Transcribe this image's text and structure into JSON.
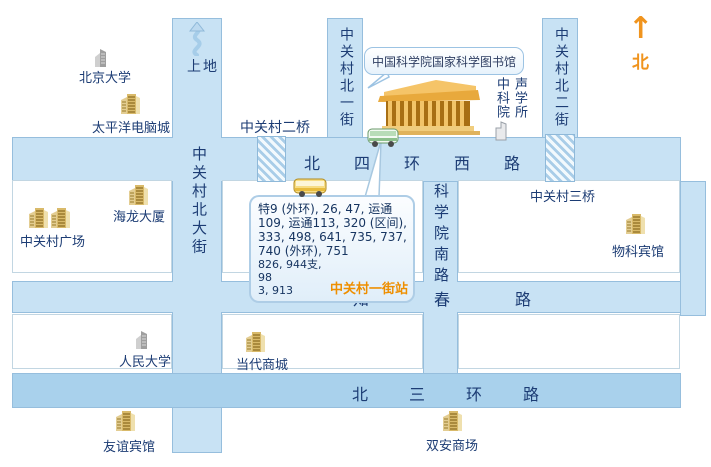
{
  "map": {
    "callout_library": "中国科学院国家科学图书馆",
    "north_indicator": {
      "arrow": "↑",
      "label": "北"
    },
    "roads": {
      "beisihuan_xilu": "北四环西路",
      "zhichun_lu": "知春路",
      "beisanhuan_lu": "北三环路",
      "zhongguancun_bei_dajie": "中关村北大街",
      "zhongguancun_beiyi_jie": "中关村北一街",
      "zhongguancun_beier_jie": "中关村北二街",
      "kexueyuan_nanlu": "科学院南路",
      "shangdi": "上地"
    },
    "bridges": {
      "erqiao": "中关村二桥",
      "sanqiao": "中关村三桥"
    },
    "bus_callout": {
      "routes_main": "特9 (外环), 26, 47, 运通109, 运通113, 320 (区间), 333, 498, 641, 735, 737, 740 (外环), 751",
      "routes_extra_line1": "826, 944支, 98",
      "routes_extra_line2": "3, 913",
      "station": "中关村一街站"
    },
    "places": {
      "beijing_university": "北京大学",
      "pacific_computer_city": "太平洋电脑城",
      "hailong_building": "海龙大厦",
      "zhongguancun_plaza": "中关村广场",
      "renmin_university": "人民大学",
      "dangdai_mall": "当代商城",
      "youyi_hotel": "友谊宾馆",
      "shuangan_mall": "双安商场",
      "wuke_hotel": "物科宾馆",
      "acoustics_left_column": "中科院",
      "acoustics_right_column": "声学所"
    },
    "colors": {
      "road_blue": "#c8e2f4",
      "third_ring_blue": "#a9d1ec",
      "road_border": "#96bedd",
      "label_navy": "#1c3c74",
      "north_orange": "#f0941e",
      "station_orange": "#ee8f00",
      "building_gold": "#d9ba6a"
    }
  }
}
